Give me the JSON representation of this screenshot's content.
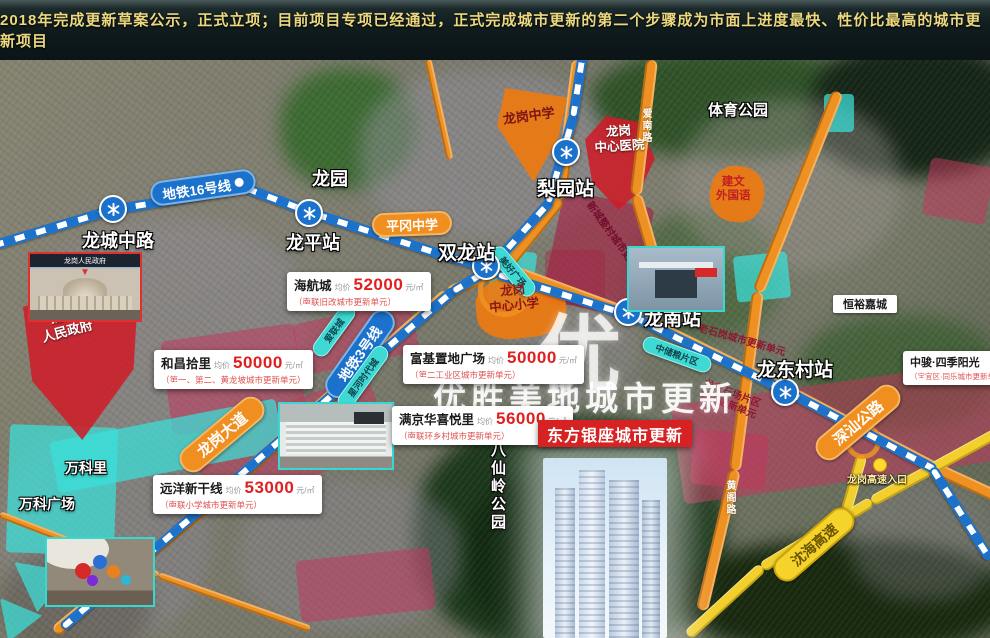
{
  "header": {
    "headline": "2018年完成更新草案公示，正式立项；目前项目专项已经通过，正式完成城市更新的第二个步骤成为市面上进度最快、性价比最高的城市更新项目"
  },
  "metro": {
    "line16_label": "地铁16号线",
    "line3_label": "地铁3号线",
    "stations": {
      "longcheng": "龙城中路",
      "longping": "龙平站",
      "shuanglong": "双龙站",
      "liyuan": "梨园站",
      "longnan": "龙南站",
      "longdongcun": "龙东村站"
    }
  },
  "roads": {
    "longgang_avenue": "龙岗大道",
    "shenshan_highway": "深汕公路",
    "shenhai_expressway": "沈海高速",
    "expressway_entrance": "龙岗高速入口",
    "road_a": "爱南路",
    "road_b": "黄阁路"
  },
  "parks": {
    "longyuan": "龙园",
    "sports_park": "体育公园",
    "baxianling": "八仙岭公园"
  },
  "schools": {
    "longgang_middle": "龙岗中学",
    "pinggang_middle": "平冈中学",
    "jianwen": "建文\n外国语",
    "center_primary": "龙岗\n中心小学"
  },
  "landmarks": {
    "hospital": "龙岗\n中心医院",
    "government": "龙岗\n人民政府",
    "government_caption": "龙岗人民政府",
    "vanke_li": "万科里",
    "vanke_plaza": "万科广场",
    "hengyu_jiacheng": "恒裕嘉城",
    "meihao_plaza": "美好广场",
    "ailian_city": "爱联城",
    "xinghe_city": "星河时代城",
    "zhongchu_area": "中储粮片区"
  },
  "renewal_zones": {
    "xincheng": "新城整村城市更新单元",
    "laoshigang": "老石岗城市更新单元",
    "longdong_shichang": "龙东石场片区\n城市更新单元"
  },
  "price_cards": {
    "avg_label": "均价",
    "unit": "元/㎡",
    "cards": [
      {
        "name": "海航城",
        "price": "52000",
        "note": "（南联旧改城市更新单元）"
      },
      {
        "name": "和昌拾里",
        "price": "50000",
        "note": "（第一、第二、黄龙坡城市更新单元）"
      },
      {
        "name": "富基置地广场",
        "price": "50000",
        "note": "（第二工业区城市更新单元）"
      },
      {
        "name": "满京华喜悦里",
        "price": "56000",
        "note": "（南联环乡村城市更新单元）"
      },
      {
        "name": "远洋新干线",
        "price": "53000",
        "note": "（南联小学城市更新单元）"
      },
      {
        "name": "中骏·四季阳光",
        "price": "",
        "note": "（宝宜区·同乐城市更新单元）"
      }
    ]
  },
  "project": {
    "banner": "东方银座城市更新"
  },
  "watermark": {
    "logo": "优",
    "text": "优胜美地城市更新"
  },
  "colors": {
    "accent_red": "#d62222",
    "metro_blue": "#1b72cc",
    "road_orange": "#ee9122",
    "expressway_yellow": "#f2cf2c",
    "cyan": "#3fd9d4",
    "price_red": "#e02020"
  }
}
